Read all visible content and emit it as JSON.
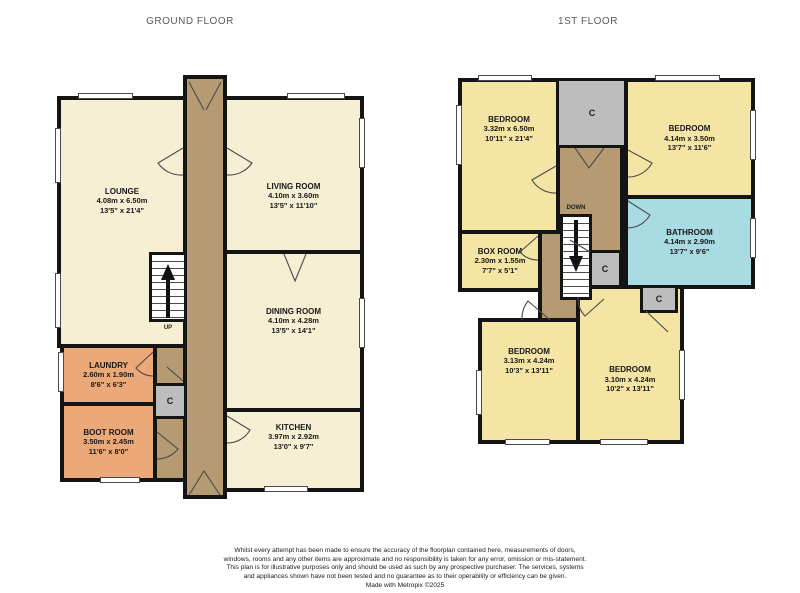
{
  "ground_floor": {
    "title": "GROUND FLOOR",
    "rooms": {
      "lounge": {
        "name": "LOUNGE",
        "metric": "4.08m x 6.50m",
        "imperial": "13'5\" x 21'4\""
      },
      "living_room": {
        "name": "LIVING ROOM",
        "metric": "4.10m x 3.60m",
        "imperial": "13'5\" x 11'10\""
      },
      "dining_room": {
        "name": "DINING ROOM",
        "metric": "4.10m x 4.28m",
        "imperial": "13'5\" x 14'1\""
      },
      "kitchen": {
        "name": "KITCHEN",
        "metric": "3.97m x 2.92m",
        "imperial": "13'0\" x 9'7\""
      },
      "laundry": {
        "name": "LAUNDRY",
        "metric": "2.60m x 1.90m",
        "imperial": "8'6\" x 6'3\""
      },
      "boot_room": {
        "name": "BOOT ROOM",
        "metric": "3.50m x 2.45m",
        "imperial": "11'6\" x 8'0\""
      }
    }
  },
  "first_floor": {
    "title": "1ST FLOOR",
    "rooms": {
      "bedroom_1": {
        "name": "BEDROOM",
        "metric": "3.32m x 6.50m",
        "imperial": "10'11\" x 21'4\""
      },
      "bedroom_2": {
        "name": "BEDROOM",
        "metric": "4.14m x 3.50m",
        "imperial": "13'7\" x 11'6\""
      },
      "bathroom": {
        "name": "BATHROOM",
        "metric": "4.14m x 2.90m",
        "imperial": "13'7\" x 9'6\""
      },
      "box_room": {
        "name": "BOX ROOM",
        "metric": "2.30m x 1.55m",
        "imperial": "7'7\" x 5'1\""
      },
      "bedroom_3": {
        "name": "BEDROOM",
        "metric": "3.13m x 4.24m",
        "imperial": "10'3\" x 13'11\""
      },
      "bedroom_4": {
        "name": "BEDROOM",
        "metric": "3.10m x 4.24m",
        "imperial": "10'2\" x 13'11\""
      }
    }
  },
  "labels": {
    "closet": "C",
    "stairs_up": "UP",
    "stairs_down": "DOWN"
  },
  "footer": {
    "disclaimer": "Whilst every attempt has been made to ensure the accuracy of the floorplan contained here, measurements of doors, windows, rooms and any other items are approximate and no responsibility is taken for any error, omission or mis-statement. This plan is for illustrative purposes only and should be used as such by any prospective purchaser. The services, systems and appliances shown have not been tested and no guarantee as to their operability or efficiency can be given.",
    "credit": "Made with Metropix ©2025"
  },
  "colors": {
    "wall": "#141414",
    "room_cream": "#f6efd3",
    "room_yellow": "#f5e5a4",
    "room_orange": "#eba979",
    "room_blue": "#a9dbe3",
    "hall_brown": "#b69a72",
    "closet_gray": "#bdbdbd"
  }
}
